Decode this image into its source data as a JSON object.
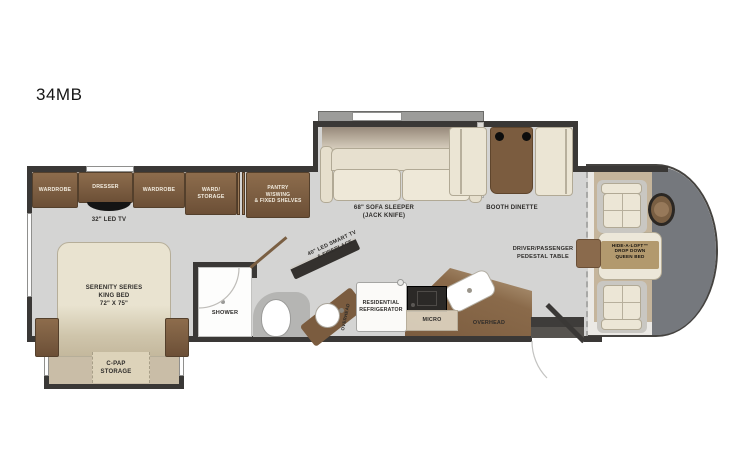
{
  "title": "34MB",
  "colors": {
    "wall": "#3a3836",
    "floor": "#d4d4d3",
    "cabinet": "#7b5d41",
    "upholstery": "#ece6d6",
    "carpet": "#c7b9a1",
    "cab_dash": "#75787d",
    "table": "#7b5c3f"
  },
  "labels": {
    "bedroom": {
      "wardrobe_left": "WARDROBE",
      "dresser": "DRESSER",
      "tv": "32\" LED TV",
      "wardrobe_right": "WARDROBE",
      "ward_storage": "WARD/\nSTORAGE",
      "bed": "SERENITY SERIES\nKING BED\n72\" X 75\"",
      "cpap": "C-PAP\nSTORAGE"
    },
    "bath": {
      "shower": "SHOWER",
      "vanity_overhead": "OVERHEAD"
    },
    "kitchen": {
      "pantry": "PANTRY\nW/SWING\n& FIXED SHELVES",
      "fridge": "RESIDENTIAL\nREFRIGERATOR",
      "micro": "MICRO",
      "overhead": "OVERHEAD"
    },
    "living": {
      "sofa_overhead": "OVERHEAD",
      "sofa": "68\" SOFA SLEEPER\n(JACK KNIFE)",
      "booth": "BOOTH DINETTE",
      "tv_fireplace": "40\" LED SMART TV\n& FIREPLACE"
    },
    "cab": {
      "pedestal_table": "DRIVER/PASSENGER\nPEDESTAL TABLE",
      "hide_a_loft": "HIDE-A-LOFT™\nDROP DOWN\nQUEEN BED"
    }
  }
}
